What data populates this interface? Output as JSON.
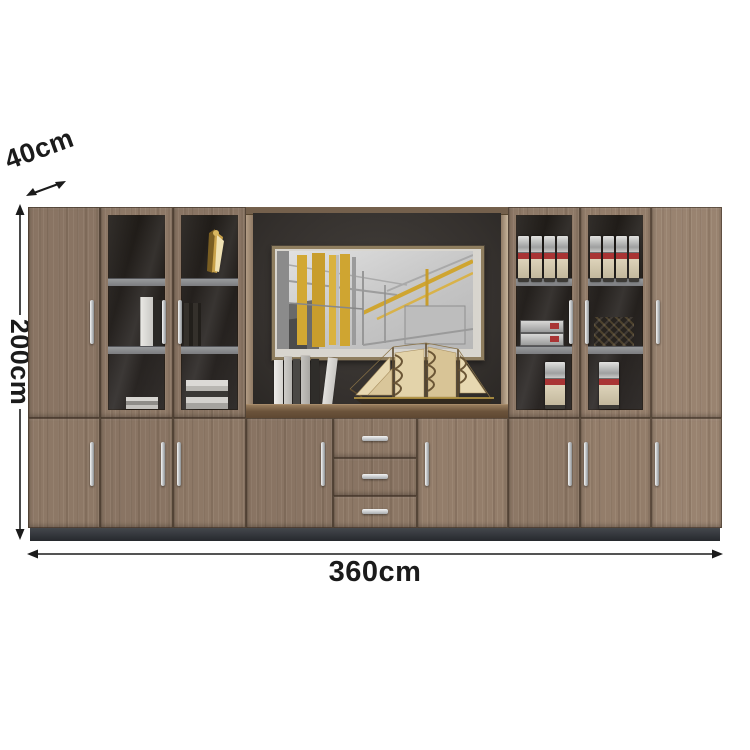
{
  "image_type": "furniture-product-dimension-diagram",
  "dimensions": {
    "depth": {
      "label": "40cm",
      "orientation": "diagonal"
    },
    "height": {
      "label": "200cm",
      "orientation": "vertical"
    },
    "width": {
      "label": "360cm",
      "orientation": "horizontal"
    }
  },
  "scene": {
    "product": "large office wall filing cabinet with glass display doors",
    "center_decor": [
      "abstract-wall-art",
      "book-stack",
      "sailing-ship-model"
    ],
    "glass_shelf_items": [
      "gold-sculpture",
      "white-books",
      "dark-books",
      "file-binders",
      "flat-binders",
      "woven-decor"
    ]
  },
  "colors": {
    "background": "#ffffff",
    "wood": "#8d7866",
    "wood_light": "#9c8874",
    "interior_dark": "#1b1713",
    "back_panel": "#38342f",
    "plinth": "#34373c",
    "counter": "#6b533b",
    "shelf_gray": "#8c8d90",
    "handle_silver": "#c6c9cb",
    "binder_red": "#a93434",
    "art_gold": "#d4a835",
    "annotation_text": "#1b1b1b"
  }
}
